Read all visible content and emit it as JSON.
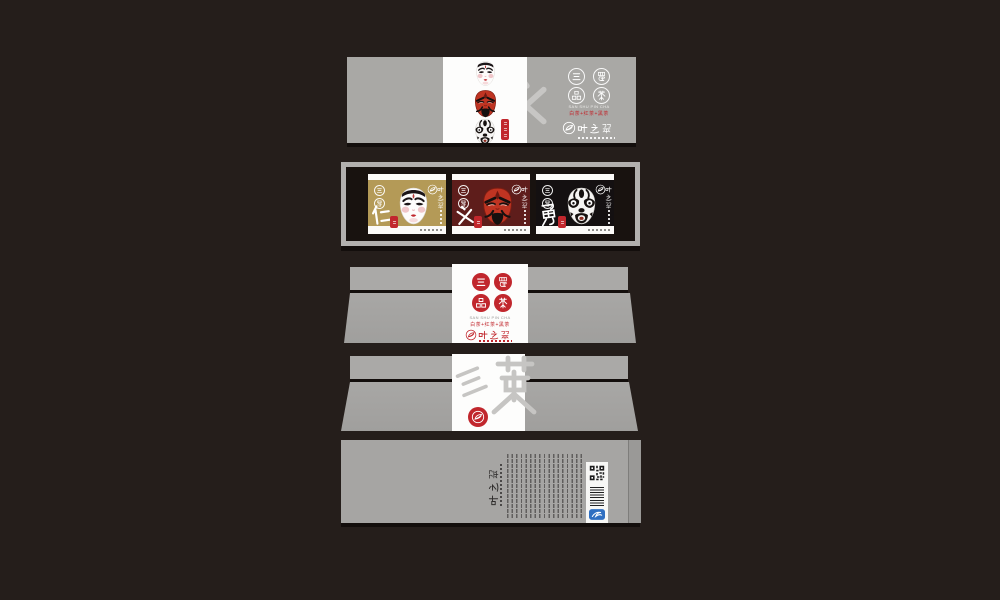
{
  "canvas": {
    "background": "#251e1b"
  },
  "brand": {
    "name": "叶之翠",
    "name_chars": [
      "叶",
      "之",
      "翠"
    ],
    "seal_title": "三蜀品茶",
    "seal_chars": [
      "三",
      "蜀",
      "品",
      "茶"
    ],
    "tagline_en": "SAN SHU PIN CHA",
    "tagline_cn": "白茶+红茶+黑茶"
  },
  "virtues": {
    "list": [
      "仁",
      "义",
      "勇"
    ],
    "front_seal": "仁义勇"
  },
  "watermarks": {
    "front_box": "仁义勇",
    "lid_back": "三英"
  },
  "packets": [
    {
      "virtue": "仁",
      "tea": "白茶",
      "background": "#b49a57",
      "mask": "white-face-mask"
    },
    {
      "virtue": "义",
      "tea": "红茶",
      "background": "#5e1d1b",
      "mask": "red-face-mask"
    },
    {
      "virtue": "勇",
      "tea": "黑茶",
      "background": "#141011",
      "mask": "black-face-mask"
    }
  ],
  "colors": {
    "seal_red": "#c1272d",
    "mask_red": "#bf3422",
    "gold": "#b49a57",
    "dark_red": "#5e1d1b",
    "box_gray": "#a9a8a5",
    "ink_black": "#171210",
    "anti_fake_blue": "#2f6fc1",
    "panel_white": "#fdfdfc"
  },
  "back_panel": {
    "brand": "叶之翠"
  }
}
